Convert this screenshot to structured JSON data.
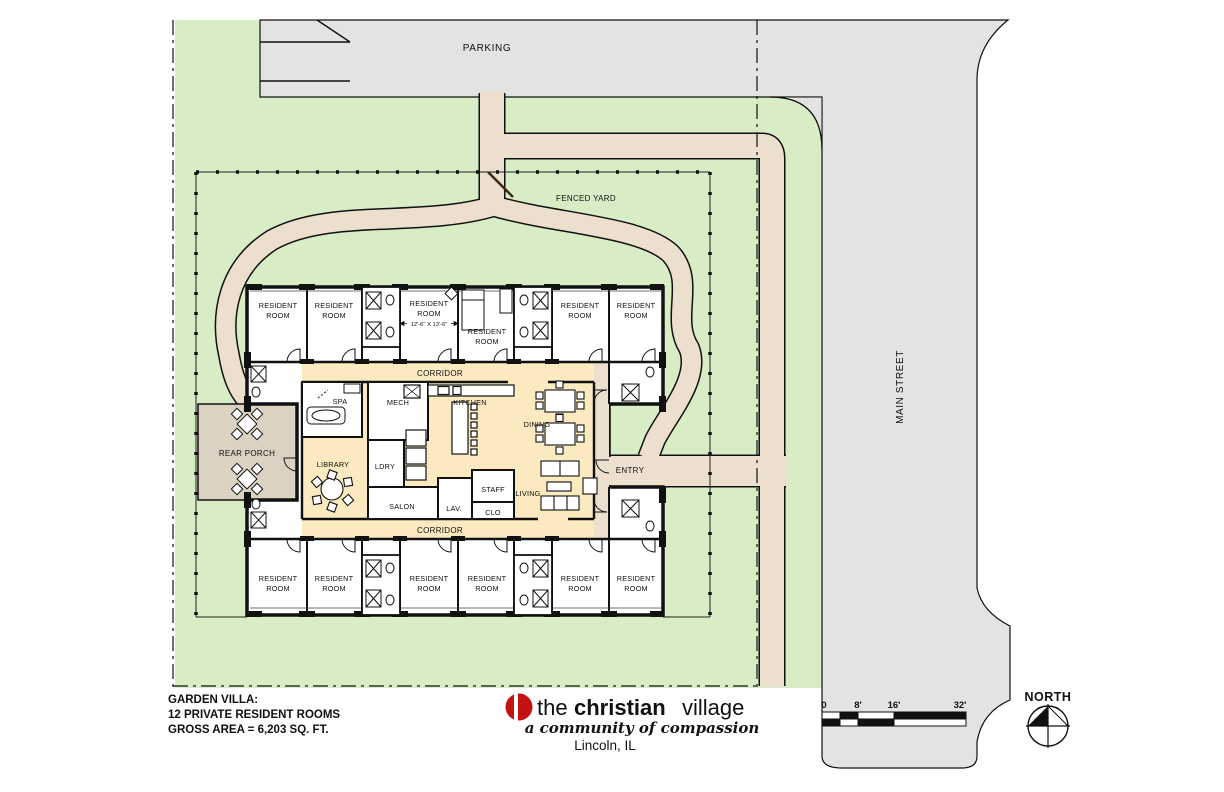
{
  "site_labels": {
    "parking": "PARKING",
    "fenced_yard": "FENCED YARD",
    "main_street": "MAIN STREET",
    "entry": "ENTRY",
    "rear_porch": "REAR PORCH",
    "north": "NORTH"
  },
  "plan_labels": {
    "resident_room": [
      "RESIDENT",
      "ROOM"
    ],
    "room_dimension": "12'-6\" X 13'-6\"",
    "corridor": "CORRIDOR",
    "spa": "SPA",
    "mech": "MECH",
    "kitchen": "KITCHEN",
    "dining": "DINING",
    "library": "LIBRARY",
    "ldry": "LDRY",
    "salon": "SALON",
    "lav": "LAV.",
    "staff": "STAFF",
    "clo": "CLO",
    "living": "LIVING"
  },
  "title_block": {
    "line1": "GARDEN VILLA:",
    "line2": "12 PRIVATE RESIDENT ROOMS",
    "line3": "GROSS AREA = 6,203 SQ. FT."
  },
  "logo": {
    "word1": "the",
    "word2": "christian",
    "word3": "village",
    "tagline": "a community of compassion",
    "location": "Lincoln, IL"
  },
  "scale_bar": {
    "labels": [
      "0",
      "8'",
      "16'",
      "32'"
    ]
  },
  "colors": {
    "lawn": "#d8ecc6",
    "pavement": "#e3e3e1",
    "walkway": "#ecdfcd",
    "porch": "#dbd2c2",
    "common_area": "#fbe9c0",
    "wall": "#111111",
    "logo_red": "#c41111"
  }
}
